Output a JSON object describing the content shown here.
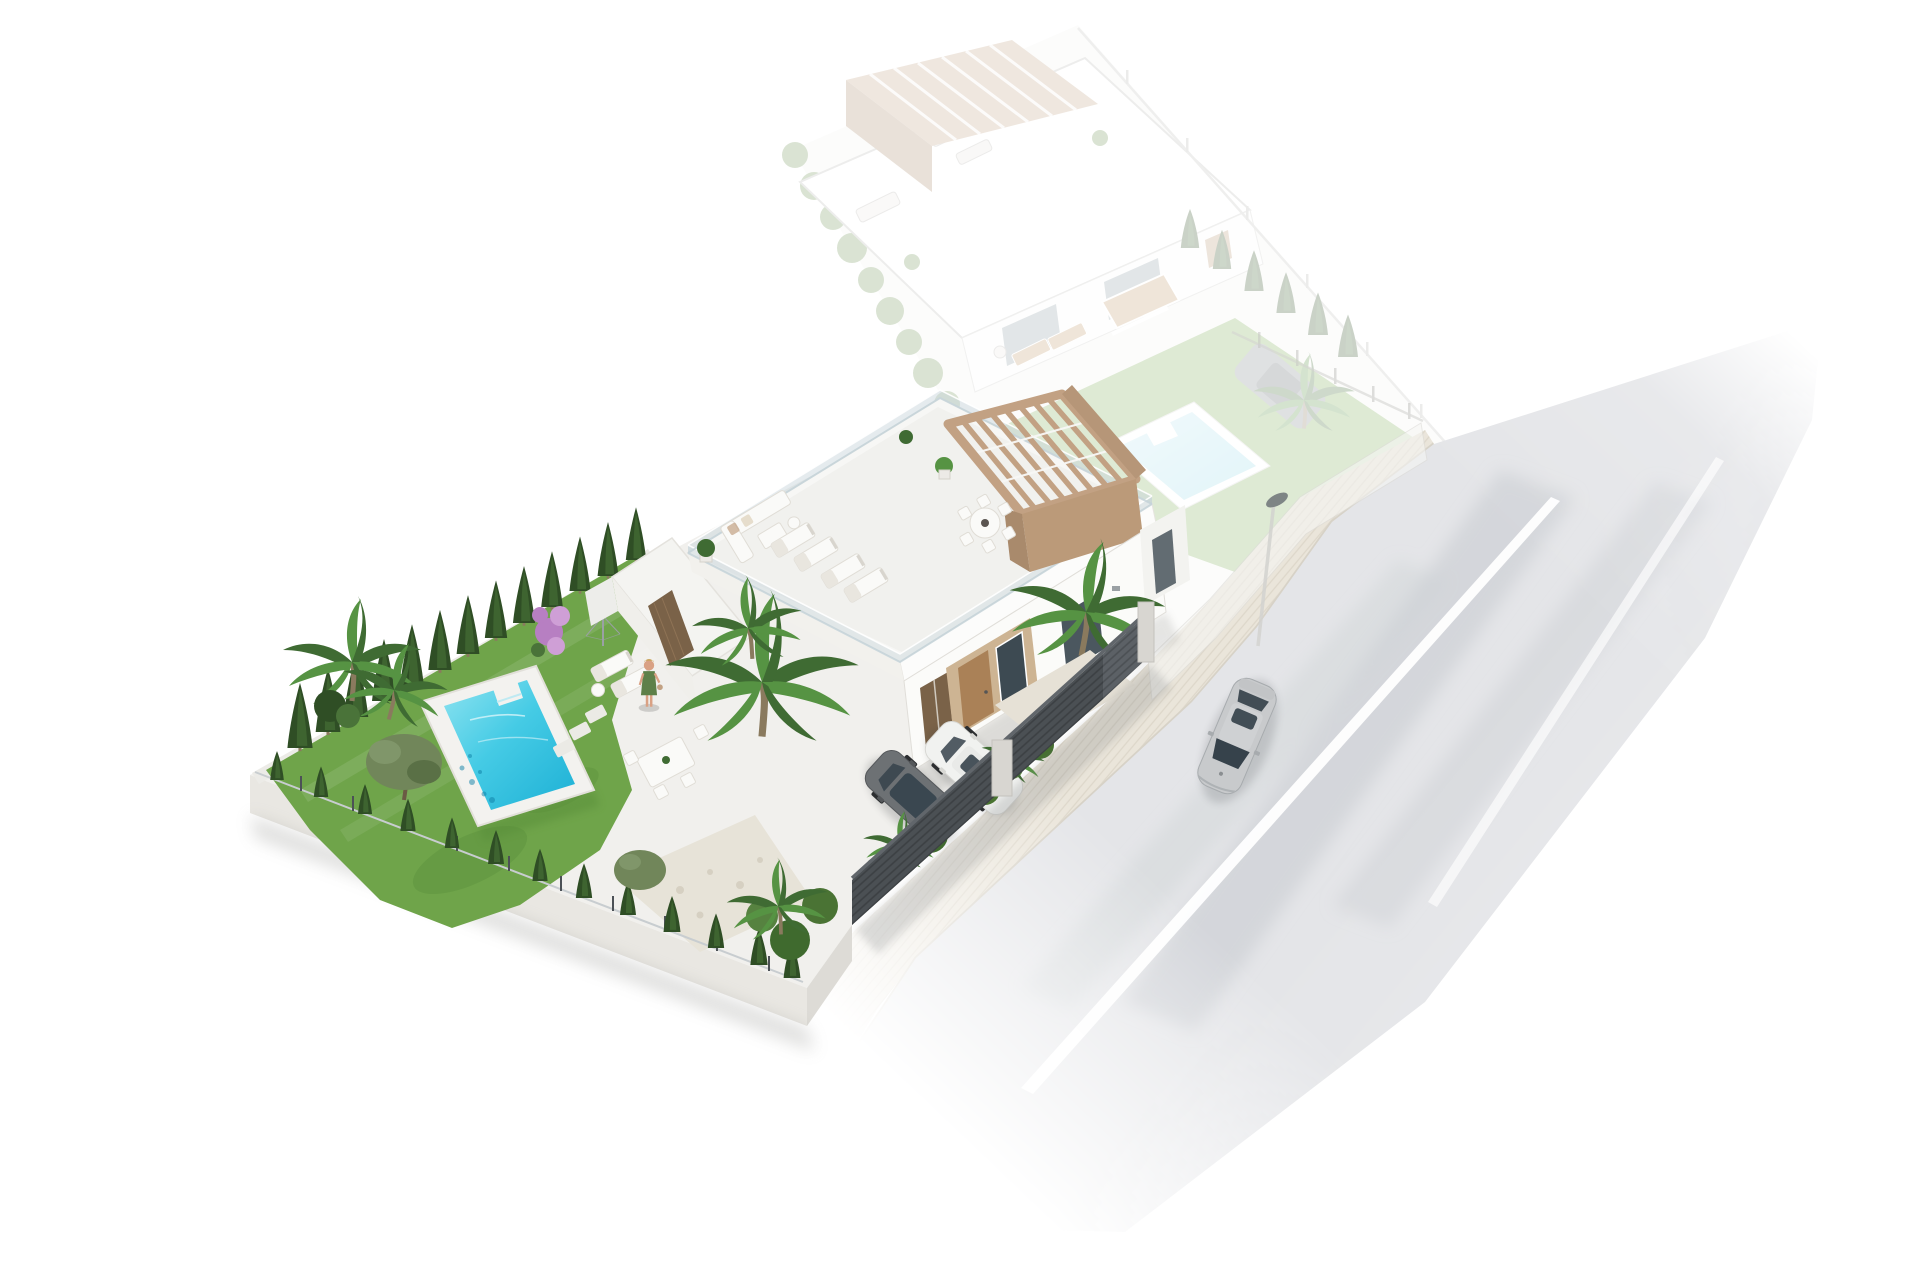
{
  "scene": {
    "title": "Aerial 3D render of a modern villa development",
    "description": "Bird's-eye architectural visualization: a modern white flat-roof villa with tan pergola, roof terrace, turquoise pool, green garden and two parked cars in full color; a ghosted identical neighbour villa with its own pool and car behind it; a light gray street with sidewalk, street lamp and a passing silver sedan on the right. No visible text in the image.",
    "background_color": "#ffffff",
    "visible_text": "none"
  },
  "palette": {
    "white": "#ffffff",
    "patio": "#f1f0ed",
    "wall-light": "#f6f6f4",
    "wall-face": "#e9e7e2",
    "wall-dark": "#dcdad4",
    "lawn": "#6fa44a",
    "lawn-dark": "#578c39",
    "cypress": "#2f4e25",
    "cypress-light": "#4a7339",
    "thuja": "#3a5c2c",
    "olive": "#71865a",
    "palm": "#3f6b33",
    "palm-light": "#569343",
    "palm-trunk": "#8a7a5e",
    "bougainvillea": "#b77fc2",
    "bougainvillea-light": "#cf9fd6",
    "pool-deck": "#f3f2ef",
    "pool-light": "#8ee3f0",
    "pool-mid": "#45cbe5",
    "pool-deep": "#1db0d5",
    "bgpool-light": "#c9ecf4",
    "bgpool-deep": "#8fd8e8",
    "pergola-tan": "#c2a183",
    "pergola-dark": "#a98a6c",
    "pergola-wall": "#bb9a79",
    "wood-door": "#aa8157",
    "wood-dark": "#7a6248",
    "beige-surround": "#cdb493",
    "glass-dark": "#3d4a52",
    "glass-rail": "#c6d3d9",
    "fence-dark": "#4b5054",
    "fence-slat": "#3a3e41",
    "fence-light": "#5c6166",
    "pillar": "#d8d6d1",
    "sidewalk": "#eae5da",
    "sidewalk-line": "#d9d2c4",
    "curb": "#d7d2c7",
    "road": "#e4e5e8",
    "road-streak": "#c7cbd0",
    "lane": "#ffffff",
    "car-silver": "#c8cacc",
    "car-silver-dark": "#a7abae",
    "car-white": "#f1f2f0",
    "car-dark": "#6d7174",
    "car-glass": "#36424b",
    "tire": "#2c2e30",
    "skin": "#d9a184",
    "dress": "#5e8049",
    "hair": "#c9a35b",
    "lamp": "#6e7478",
    "ghost-lawn": "#7fae57",
    "ghost-hedge": "#6f9455",
    "ghost-car": "#84898d",
    "ghost-glass": "#8fa0a8",
    "ghost-wood": "#c29a6b"
  },
  "foreground_villa": {
    "style": "modern white flat-roof villa with roof terrace",
    "roof_terrace": {
      "pergola": "tan wooden slatted pergola on raised corner",
      "furniture": [
        "corner sofa set with low table",
        "4 sun loungers",
        "round dining table with 6 chairs",
        "potted plants"
      ],
      "railing": "glass with white handrail"
    },
    "facade": {
      "front_door": "light wood",
      "windows": "dark glazed",
      "side_panel": "dark wood slat door on left wing"
    },
    "garden": {
      "lawn": "green with mowing shade patches",
      "pool": {
        "type": "rectangular with corner entry step",
        "water_color": "turquoise",
        "deck": "white"
      },
      "trees": {
        "cypress_row_count": 13,
        "thuja_hedge_count": 13,
        "palms": 6,
        "olive_trees": 2,
        "bougainvillea": 1
      },
      "gravel_patch": true,
      "stepping_stones": 3
    },
    "patio": {
      "furniture": [
        "2 white sun loungers",
        "round side table",
        "dining table with 4 chairs"
      ],
      "rotary_clothesline": true,
      "person": "woman in green dress standing"
    },
    "driveway": {
      "parked_cars": [
        "dark gray car",
        "white car"
      ],
      "gravel_forecourt": true
    },
    "boundary": {
      "street_fence": "dark horizontal-slat panels with concrete pillar and gate",
      "side_walls": "white low walls with thin railing"
    }
  },
  "background_villa": {
    "ghosted": true,
    "opacity": 0.25,
    "pergola": "tan slatted",
    "roof_furniture": [
      "round table",
      "2 loungers",
      "sofa",
      "plants"
    ],
    "patio_furniture": [
      "wood dining table with bench",
      "2 wooden loungers"
    ],
    "pool": {
      "type": "rectangular with step",
      "water_color": "pale cyan"
    },
    "hedges": [
      "west hedge row",
      "northeast cypress row with post fence"
    ],
    "parked_car": "dark gray",
    "palm_trees": 1
  },
  "street": {
    "road": {
      "surface": "light gray asphalt fading out at both ends",
      "lane_markings": 2
    },
    "sidewalk": "cream paver strip along plots",
    "street_lamp_count": 1,
    "moving_car": {
      "type": "silver sedan with sunroof",
      "heading": "toward bottom-left"
    }
  }
}
